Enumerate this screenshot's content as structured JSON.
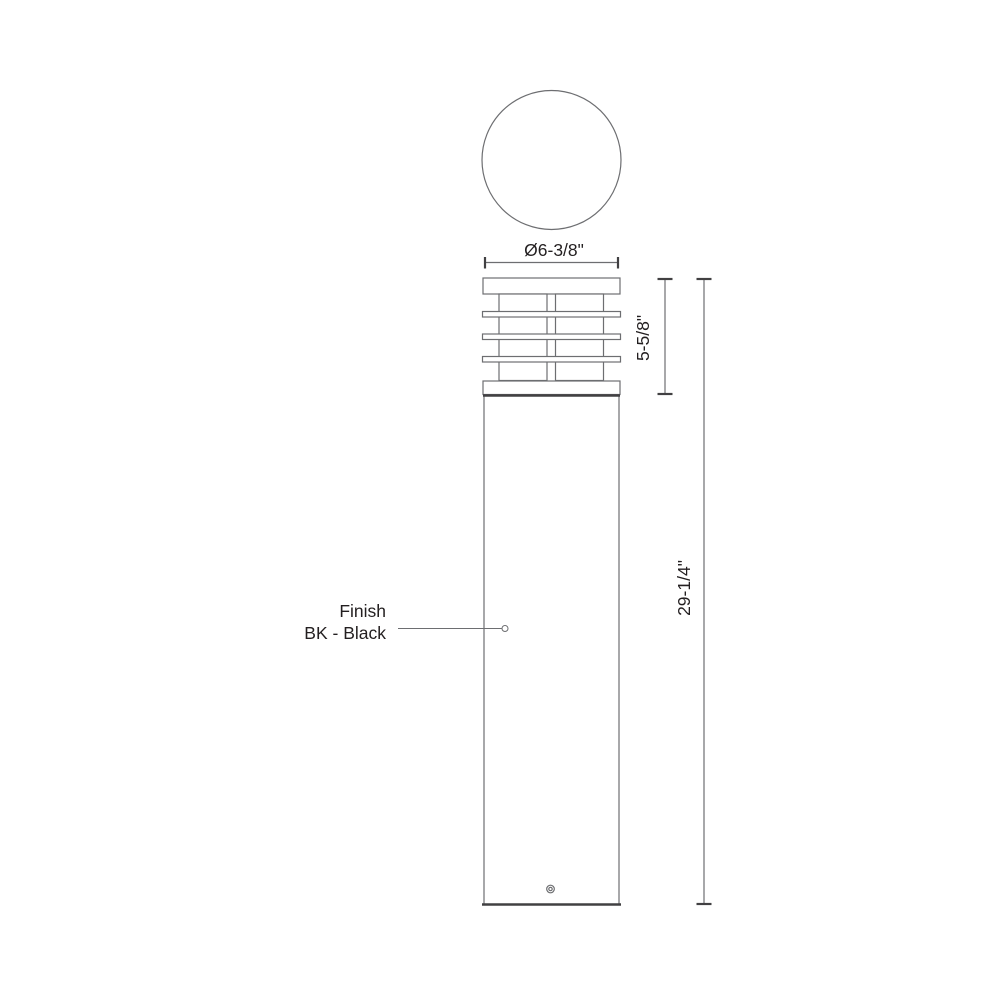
{
  "drawing": {
    "description": "Bollard light fixture dimensional line drawing, top view and side elevation",
    "colors": {
      "line": "#6d6e71",
      "dark_line": "#414042",
      "text": "#231f20",
      "background": "#ffffff"
    },
    "top_view": {
      "diameter_label": "Ø6-3/8\""
    },
    "side_view": {
      "louver_height_label": "5-5/8\"",
      "overall_height_label": "29-1/4\""
    },
    "finish_callout": {
      "line1": "Finish",
      "line2": "BK - Black"
    }
  }
}
